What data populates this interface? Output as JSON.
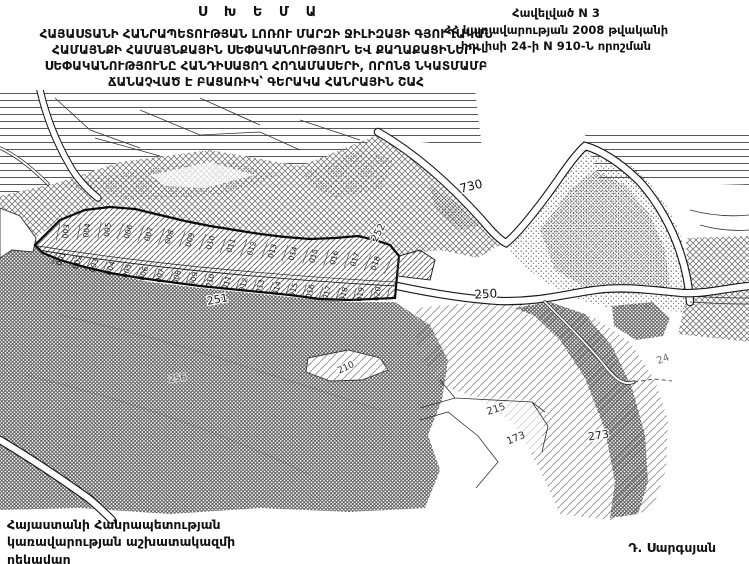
{
  "document": {
    "scheme_label": "Ս Խ Ե Մ Ա",
    "appendix": [
      "Հավելված N 3",
      "ՀՀ կառավարության 2008 թվականի",
      "հուլիսի 24-ի N 910-Ն որոշման"
    ],
    "title": [
      "ՀԱՅԱՍՏԱՆԻ ՀԱՆՐԱՊԵՏՈՒԹՅԱՆ ԼՈՌՈՒ ՄԱՐԶԻ ՋԻԼԻԶԱՅԻ ԳՅՈՒՂԱԿԱՆ",
      "ՀԱՄԱՅՆՔԻ ՀԱՄԱՅՆՔԱՅԻՆ ՍԵՓԱԿԱՆՈՒԹՅՈՒՆ ԵՎ ՔԱՂԱՔԱՑԻՆԵՐԻ",
      "ՍԵՓԱԿԱՆՈՒԹՅՈՒՆԸ ՀԱՆԴԻՍԱՑՈՂ ՀՈՂԱՄԱՍԵՐԻ, ՈՐՈՆՑ ՆԿԱՏՄԱՄԲ",
      "ՃԱՆԱՉՎԱԾ Է ԲԱՑԱՌԻԿ՝ ԳԵՐԱԿԱ ՀԱՆՐԱՅԻՆ ՇԱՀ"
    ],
    "footer": {
      "office": [
        "Հայաստանի Հանրապետության",
        "կառավարության աշխատակազմի",
        "ղեկավար"
      ],
      "signature": "Դ. Սարգսյան"
    }
  },
  "map": {
    "ink": "#111111",
    "labels": [
      {
        "text": "730",
        "x": 472,
        "y": 100,
        "rot": -14,
        "size": 12,
        "op": 1
      },
      {
        "text": "250",
        "x": 486,
        "y": 208,
        "rot": -3,
        "size": 12,
        "op": 1
      },
      {
        "text": "251",
        "x": 218,
        "y": 213,
        "rot": -10,
        "size": 11,
        "op": 1
      },
      {
        "text": "252",
        "x": 381,
        "y": 144,
        "rot": -62,
        "size": 10,
        "op": 0.9
      },
      {
        "text": "210",
        "x": 347,
        "y": 280,
        "rot": -25,
        "size": 9,
        "op": 0.9
      },
      {
        "text": "256",
        "x": 178,
        "y": 291,
        "rot": -8,
        "size": 9,
        "op": 0.5
      },
      {
        "text": "215",
        "x": 497,
        "y": 322,
        "rot": -18,
        "size": 10,
        "op": 0.85
      },
      {
        "text": "173",
        "x": 517,
        "y": 351,
        "rot": -22,
        "size": 10,
        "op": 0.9
      },
      {
        "text": "273",
        "x": 599,
        "y": 349,
        "rot": -8,
        "size": 11,
        "op": 0.9
      },
      {
        "text": "24",
        "x": 664,
        "y": 272,
        "rot": -20,
        "size": 10,
        "op": 0.6
      }
    ],
    "parcel_top_row": [
      "003",
      "004",
      "005",
      "006",
      "007",
      "008",
      "009",
      "010",
      "011",
      "012",
      "013",
      "014",
      "015",
      "016",
      "017",
      "018"
    ],
    "parcel_bottom_row": [
      "001",
      "002",
      "003",
      "004",
      "005",
      "006",
      "007",
      "008",
      "009",
      "010",
      "011",
      "012",
      "013",
      "014",
      "015",
      "016",
      "017",
      "018",
      "019",
      "020"
    ]
  }
}
